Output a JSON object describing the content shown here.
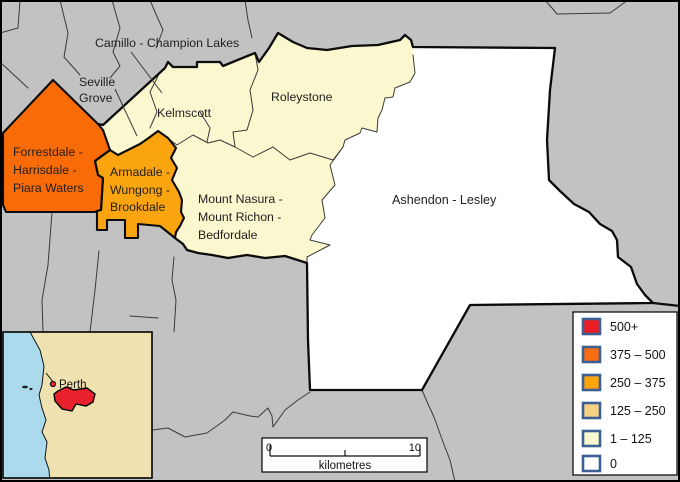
{
  "map_background_color": "#C2C2C2",
  "regions": {
    "camillo": {
      "label": "Camillo - Champion Lakes"
    },
    "seville_grove": {
      "line1": "Seville",
      "line2": "Grove"
    },
    "kelmscott": {
      "label": "Kelmscott",
      "color": "#FBF7CE"
    },
    "roleystone": {
      "label": "Roleystone",
      "color": "#FBF7CE"
    },
    "forrestdale": {
      "line1": "Forrestdale -",
      "line2": "Harrisdale -",
      "line3": "Piara Waters",
      "color": "#F96B07"
    },
    "armadale": {
      "line1": "Armadale -",
      "line2": "Wungong -",
      "line3": "Brookdale",
      "color": "#FAA410"
    },
    "mount_nasura": {
      "line1": "Mount Nasura -",
      "line2": "Mount Richon -",
      "line3": "Bedfordale",
      "color": "#FBF7CE"
    },
    "ashendon": {
      "label": "Ashendon - Lesley",
      "color": "#FFFFFF"
    }
  },
  "legend": {
    "swatch_border_color": "#3C6094",
    "items": [
      {
        "label": "500+",
        "color": "#EC1C24"
      },
      {
        "label": "375 – 500",
        "color": "#F76D14"
      },
      {
        "label": "250 – 375",
        "color": "#FAA410"
      },
      {
        "label": "125 – 250",
        "color": "#F5D382"
      },
      {
        "label": "1 – 125",
        "color": "#FBF7CE"
      },
      {
        "label": "0",
        "color": "#FFFFFF"
      }
    ]
  },
  "scalebar": {
    "start_label": "0",
    "end_label": "10",
    "unit_label": "kilometres"
  },
  "inset": {
    "city_label": "Perth",
    "water_color": "#ABDAEC",
    "land_color": "#EFE2B0",
    "highlight_color": "#E8212D"
  }
}
